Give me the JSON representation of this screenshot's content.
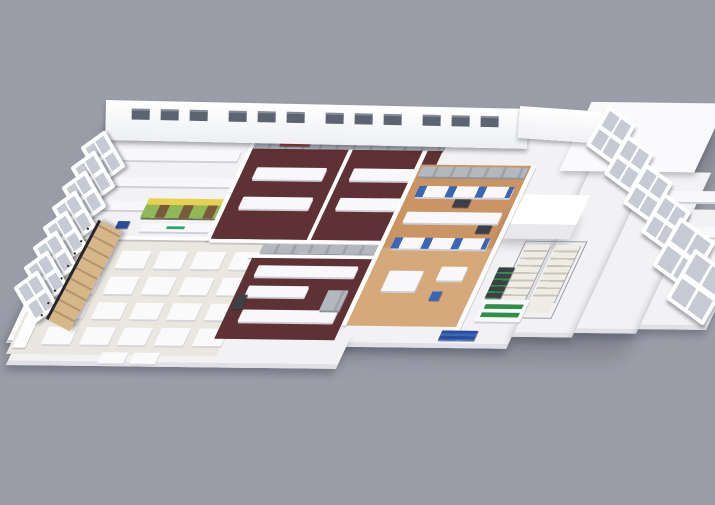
{
  "scene": {
    "title": "3D isometric cutaway rendering of a laboratory facility floor plan",
    "background": "#9B9EA9"
  },
  "palette": {
    "slab": "#F2F2F4",
    "slab_edge": "#E0E0E6",
    "wall": "#FDFDFE",
    "classroom_floor": "#EAE7E0",
    "table_white": "#FAFAFB",
    "maroon_floor": "#5E3134",
    "wood_floor": "#CB9463",
    "wood_floor_light": "#E0BA8E",
    "steel": "#B3B7BE",
    "equip_dark": "#3C3F46",
    "navy": "#2C4C9C",
    "blue": "#3A66B8",
    "yellow": "#E8D052",
    "shelf_green": "#8FB957",
    "shelf_brown": "#7A5A3A",
    "teal": "#63BFA2",
    "logo_green": "#2EA36A",
    "red_sign": "#A03A3C",
    "window_pane": "#C5CAD4",
    "back_window": "#5C6472",
    "cold_room": "#FFFFFF",
    "roof": "#FAFAFC",
    "rack_green": "#2F8F46"
  },
  "counts": {
    "tables": 20,
    "back_windows": 12,
    "left_windows": 8,
    "right_windows": 6,
    "nw_machines": 5
  },
  "zones": {
    "classroom": {
      "name": "open room with grid of white tables",
      "rows": 4,
      "cols": 5
    },
    "retail_shelf": {
      "name": "display shelving unit with yellow fascia, green and brown stock, teal end cap and white counter with green logo"
    },
    "northwest_labs": {
      "name": "white labs with gray analyzer machines"
    },
    "kitchen_a": {
      "name": "maroon-floor room A with double white benches and stainless hood row"
    },
    "kitchen_b": {
      "name": "maroon-floor room B with white counters and stainless equipment"
    },
    "wood_lab": {
      "name": "wood-floor lab with white benches and blue equipment"
    },
    "cold_room": {
      "name": "tall white walk-in chamber"
    },
    "stair": {
      "name": "switchback staircase with railings",
      "flights": 2
    },
    "right_wing": {
      "name": "stepped white lab wing with benches and tilted window frames"
    }
  }
}
